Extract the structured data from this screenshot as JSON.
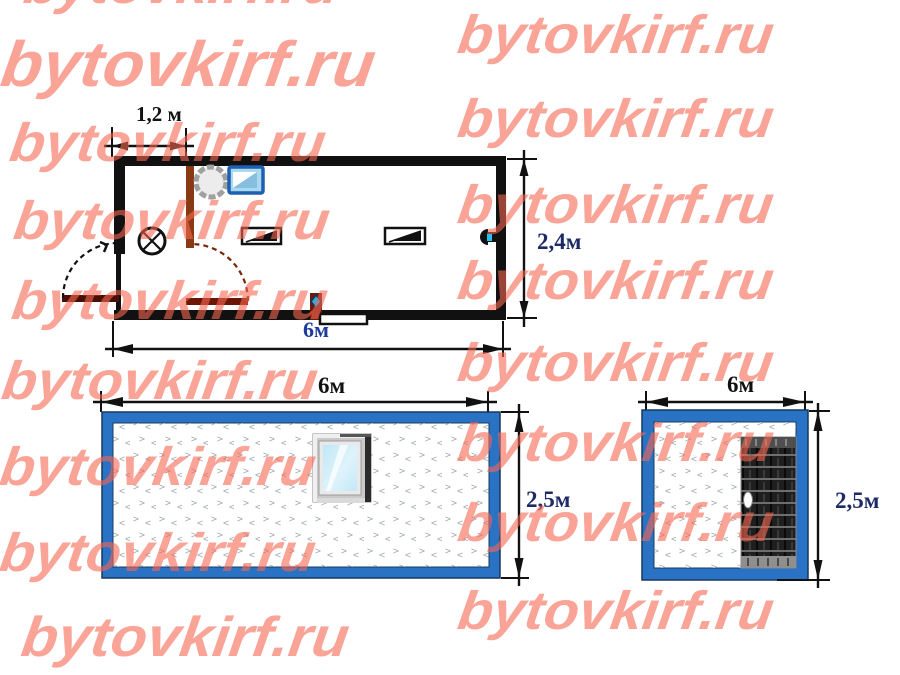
{
  "watermark": {
    "text": "bytovkirf.ru",
    "color": "rgba(246,104,84,0.60)",
    "positions": [
      {
        "x": 28,
        "y": -40,
        "fs": 54
      },
      {
        "x": 462,
        "y": 10,
        "fs": 54
      },
      {
        "x": 6,
        "y": 34,
        "fs": 64
      },
      {
        "x": 462,
        "y": 94,
        "fs": 54
      },
      {
        "x": 14,
        "y": 118,
        "fs": 54
      },
      {
        "x": 462,
        "y": 180,
        "fs": 54
      },
      {
        "x": 18,
        "y": 196,
        "fs": 54
      },
      {
        "x": 462,
        "y": 256,
        "fs": 54
      },
      {
        "x": 16,
        "y": 276,
        "fs": 54
      },
      {
        "x": 462,
        "y": 338,
        "fs": 54
      },
      {
        "x": 6,
        "y": 356,
        "fs": 54
      },
      {
        "x": 462,
        "y": 418,
        "fs": 54
      },
      {
        "x": 4,
        "y": 442,
        "fs": 54
      },
      {
        "x": 462,
        "y": 498,
        "fs": 54
      },
      {
        "x": 4,
        "y": 528,
        "fs": 54
      },
      {
        "x": 462,
        "y": 586,
        "fs": 54
      },
      {
        "x": 26,
        "y": 610,
        "fs": 56
      }
    ]
  },
  "plan": {
    "label_wc_width": "1,2 м",
    "label_height": "2,4м",
    "label_width": "6м"
  },
  "side_view": {
    "label_width": "6м",
    "label_height": "2,5м"
  },
  "end_view": {
    "label_width": "6м",
    "label_height": "2,5м"
  },
  "colors": {
    "frame_blue": "#2a72c4",
    "outline_navy": "#16395f",
    "wall_black": "#111111",
    "wood_brown": "#7a2408",
    "dim_text_navy": "#1e2a66",
    "plan_width_blue": "#1d3a9e",
    "glass_cyan": "#c9ecf8",
    "pattern_gray": "#a3adb2",
    "sink_blue": "#1d5fb0",
    "socket_cyan": "#20c4f0"
  }
}
